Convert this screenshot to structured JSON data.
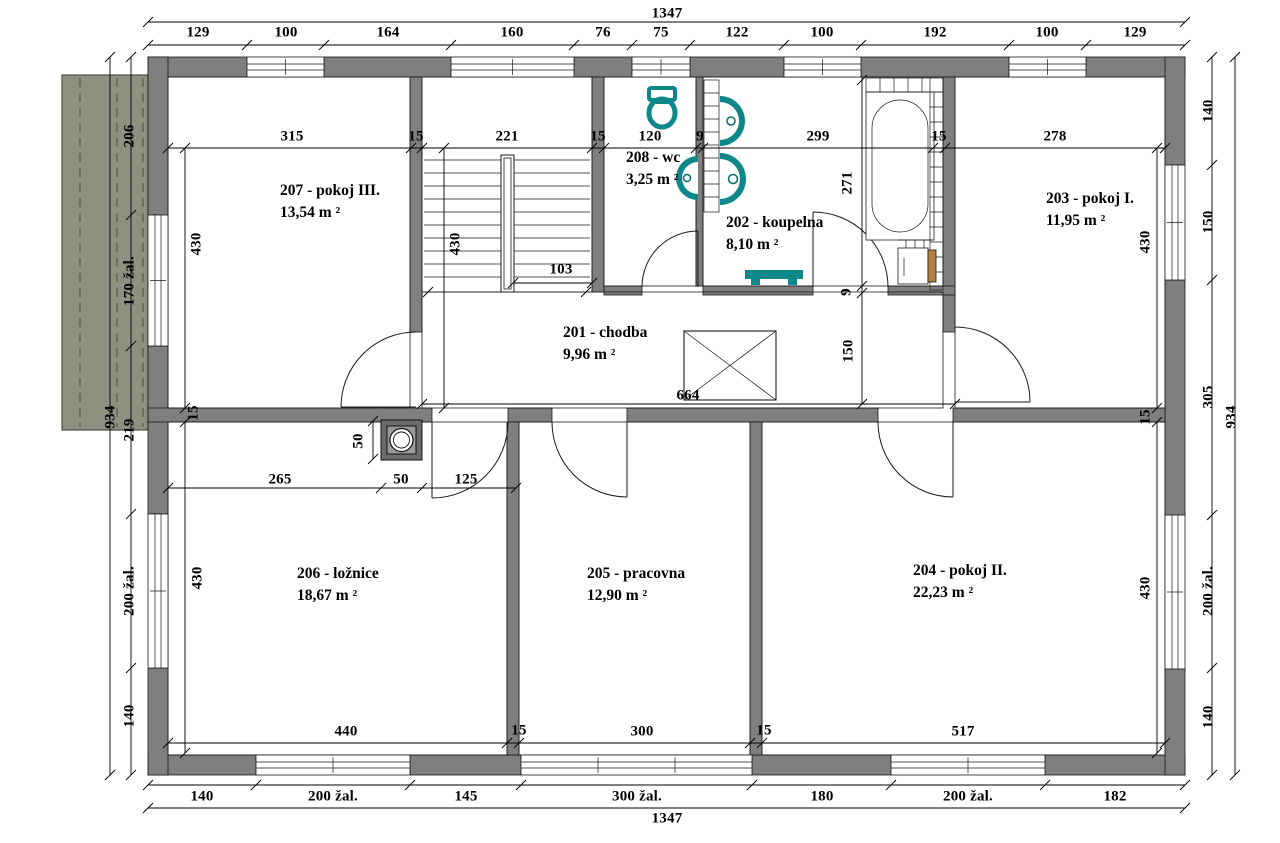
{
  "overall": {
    "width": "1347",
    "height": "934"
  },
  "colors": {
    "wall": "#7f7f7f",
    "fixture": "#0d8789",
    "balcony": "#8e9181",
    "balcony_line": "#5f6450",
    "wood": "#b5803f"
  },
  "rooms": [
    {
      "id": "201",
      "name": "201 - chodba",
      "area": "9,96 m ²",
      "x": 563,
      "y": 322
    },
    {
      "id": "202",
      "name": "202 - koupelna",
      "area": "8,10 m ²",
      "x": 726,
      "y": 212
    },
    {
      "id": "203",
      "name": "203 - pokoj I.",
      "area": "11,95 m ²",
      "x": 1046,
      "y": 188
    },
    {
      "id": "204",
      "name": "204 - pokoj II.",
      "area": "22,23 m ²",
      "x": 913,
      "y": 560
    },
    {
      "id": "205",
      "name": "205 - pracovna",
      "area": "12,90 m ²",
      "x": 587,
      "y": 563
    },
    {
      "id": "206",
      "name": "206 - ložnice",
      "area": "18,67 m ²",
      "x": 297,
      "y": 563
    },
    {
      "id": "207",
      "name": "207 - pokoj III.",
      "area": "13,54 m ²",
      "x": 280,
      "y": 180
    },
    {
      "id": "208",
      "name": "208 - wc",
      "area": "3,25 m ²",
      "x": 626,
      "y": 147
    }
  ],
  "dim_labels": [
    {
      "t": "129",
      "x": 198,
      "y": 33
    },
    {
      "t": "100",
      "x": 286,
      "y": 33
    },
    {
      "t": "164",
      "x": 388,
      "y": 33
    },
    {
      "t": "160",
      "x": 512,
      "y": 33
    },
    {
      "t": "76",
      "x": 603,
      "y": 33
    },
    {
      "t": "75",
      "x": 661,
      "y": 33
    },
    {
      "t": "122",
      "x": 737,
      "y": 33
    },
    {
      "t": "100",
      "x": 822,
      "y": 33
    },
    {
      "t": "192",
      "x": 935,
      "y": 33
    },
    {
      "t": "100",
      "x": 1047,
      "y": 33
    },
    {
      "t": "129",
      "x": 1135,
      "y": 33
    },
    {
      "t": "315",
      "x": 292,
      "y": 137
    },
    {
      "t": "15",
      "x": 416,
      "y": 137
    },
    {
      "t": "221",
      "x": 507,
      "y": 137
    },
    {
      "t": "15",
      "x": 598,
      "y": 137
    },
    {
      "t": "120",
      "x": 650,
      "y": 137
    },
    {
      "t": "9",
      "x": 700,
      "y": 137
    },
    {
      "t": "299",
      "x": 818,
      "y": 137
    },
    {
      "t": "15",
      "x": 939,
      "y": 137
    },
    {
      "t": "278",
      "x": 1055,
      "y": 137
    },
    {
      "t": "430",
      "x": 197,
      "y": 244,
      "r": 1
    },
    {
      "t": "430",
      "x": 456,
      "y": 244,
      "r": 1
    },
    {
      "t": "103",
      "x": 561,
      "y": 270
    },
    {
      "t": "271",
      "x": 848,
      "y": 183,
      "r": 1
    },
    {
      "t": "9",
      "x": 847,
      "y": 292,
      "r": 1
    },
    {
      "t": "150",
      "x": 849,
      "y": 351,
      "r": 1
    },
    {
      "t": "430",
      "x": 1146,
      "y": 242,
      "r": 1
    },
    {
      "t": "664",
      "x": 688,
      "y": 396
    },
    {
      "t": "15",
      "x": 194,
      "y": 413,
      "r": 1
    },
    {
      "t": "15",
      "x": 1146,
      "y": 417,
      "r": 1
    },
    {
      "t": "50",
      "x": 359,
      "y": 441,
      "r": 1
    },
    {
      "t": "265",
      "x": 280,
      "y": 480
    },
    {
      "t": "50",
      "x": 401,
      "y": 480
    },
    {
      "t": "125",
      "x": 466,
      "y": 480
    },
    {
      "t": "430",
      "x": 198,
      "y": 578,
      "r": 1
    },
    {
      "t": "430",
      "x": 1146,
      "y": 588,
      "r": 1
    },
    {
      "t": "440",
      "x": 346,
      "y": 732
    },
    {
      "t": "15",
      "x": 519,
      "y": 731
    },
    {
      "t": "300",
      "x": 642,
      "y": 732
    },
    {
      "t": "15",
      "x": 764,
      "y": 731
    },
    {
      "t": "517",
      "x": 963,
      "y": 732
    },
    {
      "t": "206",
      "x": 130,
      "y": 136,
      "r": 1
    },
    {
      "t": "170 žal.",
      "x": 130,
      "y": 281,
      "r": 1
    },
    {
      "t": "219",
      "x": 130,
      "y": 430,
      "r": 1
    },
    {
      "t": "200 žal.",
      "x": 130,
      "y": 591,
      "r": 1
    },
    {
      "t": "140",
      "x": 130,
      "y": 716,
      "r": 1
    },
    {
      "t": "140",
      "x": 1209,
      "y": 111,
      "r": 1
    },
    {
      "t": "150",
      "x": 1209,
      "y": 222,
      "r": 1
    },
    {
      "t": "305",
      "x": 1209,
      "y": 397,
      "r": 1
    },
    {
      "t": "200 žal.",
      "x": 1209,
      "y": 591,
      "r": 1
    },
    {
      "t": "140",
      "x": 1209,
      "y": 717,
      "r": 1
    },
    {
      "t": "140",
      "x": 202,
      "y": 797
    },
    {
      "t": "200 žal.",
      "x": 333,
      "y": 797
    },
    {
      "t": "145",
      "x": 466,
      "y": 797
    },
    {
      "t": "300 žal.",
      "x": 637,
      "y": 797
    },
    {
      "t": "180",
      "x": 822,
      "y": 797
    },
    {
      "t": "200 žal.",
      "x": 968,
      "y": 797
    },
    {
      "t": "182",
      "x": 1115,
      "y": 797
    }
  ]
}
